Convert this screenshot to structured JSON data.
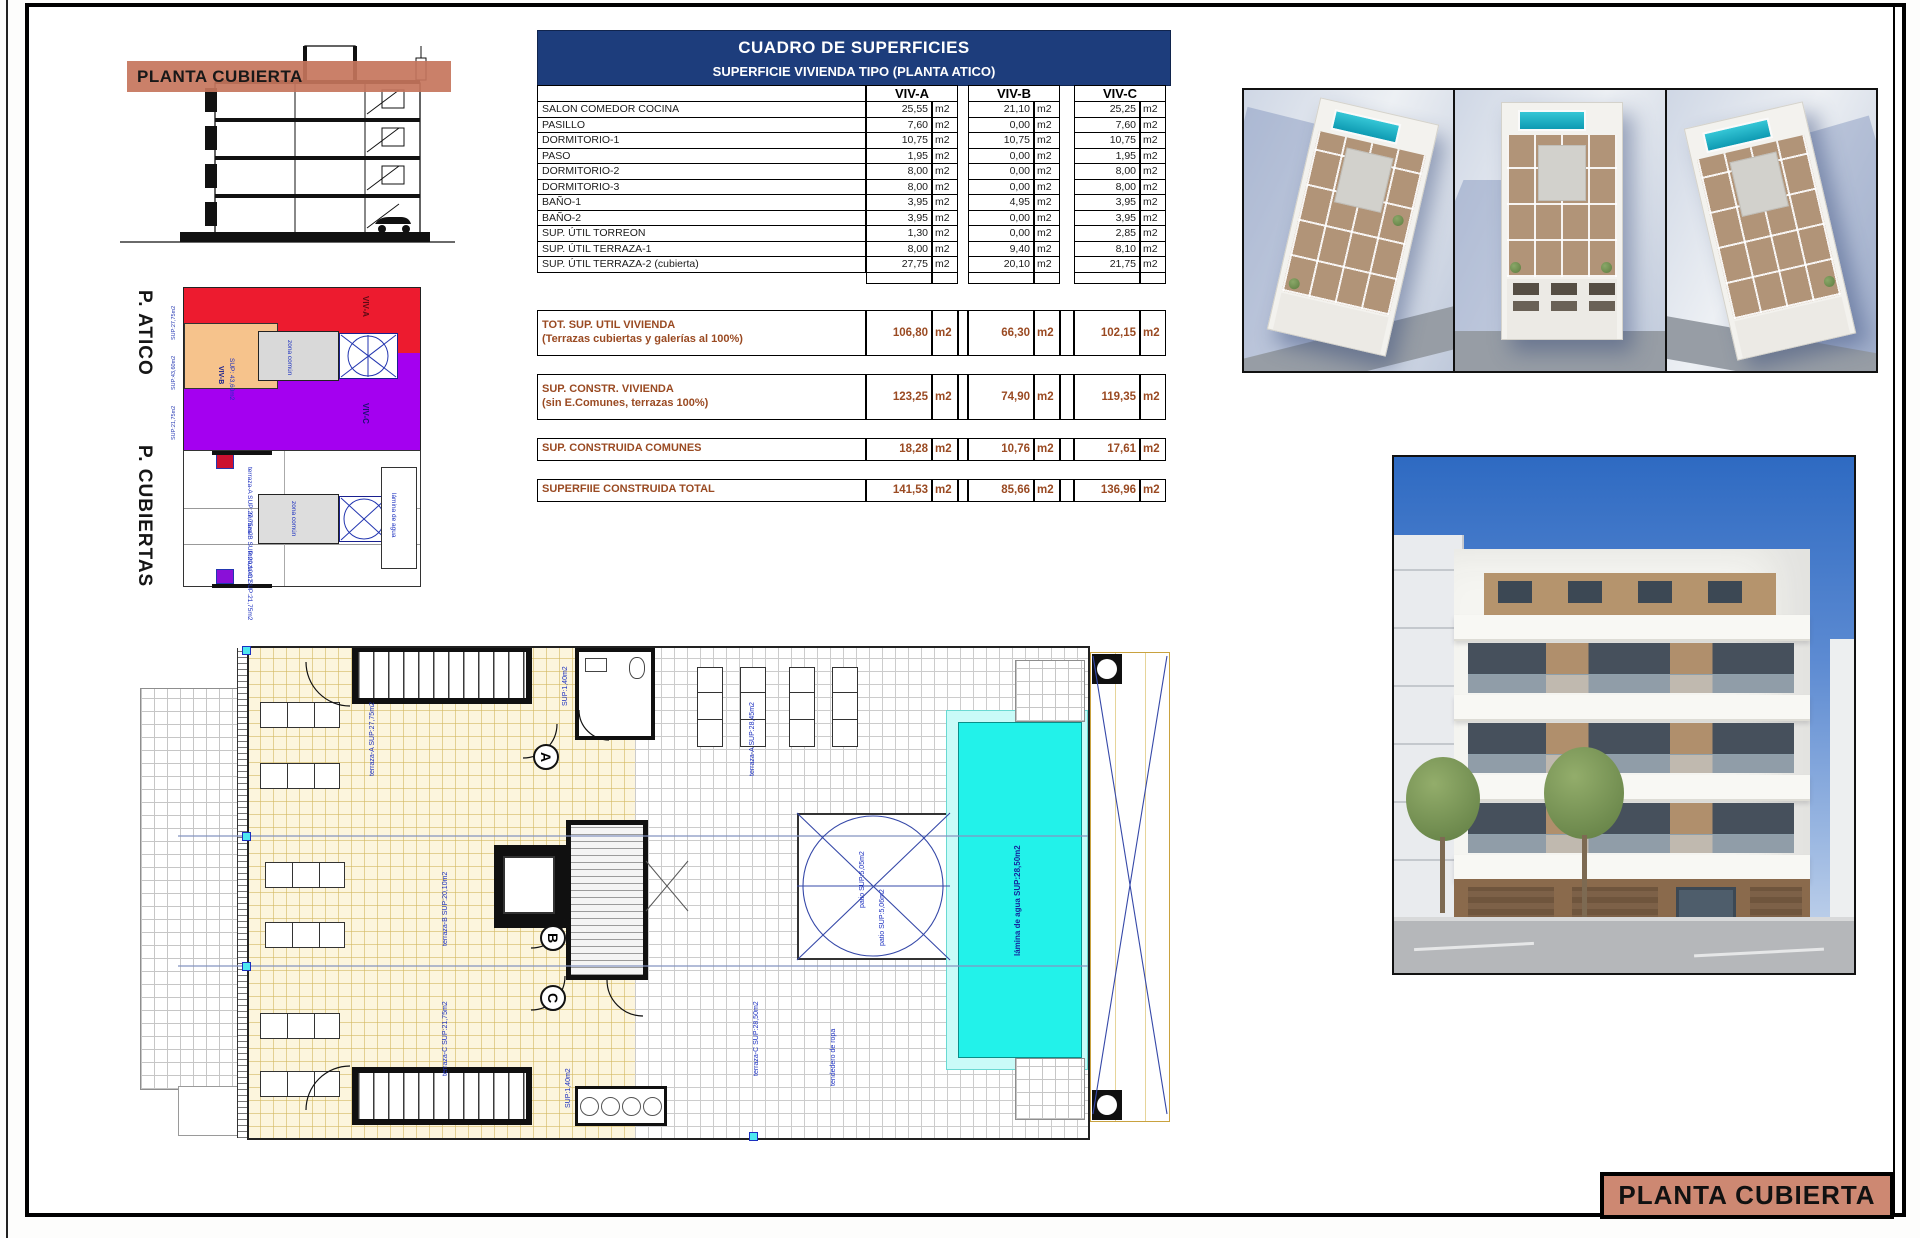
{
  "section": {
    "band_label": "PLANTA CUBIERTA"
  },
  "atico": {
    "title": "P. ATICO",
    "viv_a": "VIV-A",
    "viv_b": "VIV-B",
    "viv_b_sup": "SUP: 43,60m2",
    "viv_c": "VIV-C",
    "zona": "zona común",
    "side_labels": [
      "SUP:27,75m2",
      "SUP:43,60m2",
      "SUP:21,75m2"
    ]
  },
  "cubiertas": {
    "title": "P. CUBIERTAS",
    "labels": {
      "t_a": "terraza-A SUP:27,75m2",
      "t_b": "terraza-B SUP:20,10m2",
      "t_c": "terraza-C SUP:21,75m2",
      "zona": "zona común",
      "pool": "lámina de agua"
    }
  },
  "table": {
    "title": "CUADRO DE SUPERFICIES",
    "subtitle": "SUPERFICIE VIVIENDA TIPO  (PLANTA ATICO)",
    "columns": [
      "VIV-A",
      "VIV-B",
      "VIV-C"
    ],
    "unit": "m2",
    "rows": [
      {
        "label": "SALON COMEDOR COCINA",
        "values": [
          "25,55",
          "21,10",
          "25,25"
        ]
      },
      {
        "label": "PASILLO",
        "values": [
          "7,60",
          "0,00",
          "7,60"
        ]
      },
      {
        "label": "DORMITORIO-1",
        "values": [
          "10,75",
          "10,75",
          "10,75"
        ]
      },
      {
        "label": "PASO",
        "values": [
          "1,95",
          "0,00",
          "1,95"
        ]
      },
      {
        "label": "DORMITORIO-2",
        "values": [
          "8,00",
          "0,00",
          "8,00"
        ]
      },
      {
        "label": "DORMITORIO-3",
        "values": [
          "8,00",
          "0,00",
          "8,00"
        ]
      },
      {
        "label": "BAÑO-1",
        "values": [
          "3,95",
          "4,95",
          "3,95"
        ]
      },
      {
        "label": "BAÑO-2",
        "values": [
          "3,95",
          "0,00",
          "3,95"
        ]
      },
      {
        "label": "SUP. ÚTIL TORREON",
        "values": [
          "1,30",
          "0,00",
          "2,85"
        ]
      },
      {
        "label": "SUP. ÚTIL TERRAZA-1",
        "values": [
          "8,00",
          "9,40",
          "8,10"
        ]
      },
      {
        "label": "SUP. ÚTIL TERRAZA-2 (cubierta)",
        "values": [
          "27,75",
          "20,10",
          "21,75"
        ]
      }
    ],
    "totals": [
      {
        "label": "TOT. SUP. UTIL VIVIENDA",
        "sublabel": "(Terrazas cubiertas y galerías al 100%)",
        "values": [
          "106,80",
          "66,30",
          "102,15"
        ]
      },
      {
        "label": "SUP. CONSTR. VIVIENDA",
        "sublabel": "(sin E.Comunes, terrazas 100%)",
        "values": [
          "123,25",
          "74,90",
          "119,35"
        ]
      },
      {
        "label": "SUP. CONSTRUIDA COMUNES",
        "sublabel": "",
        "values": [
          "18,28",
          "10,76",
          "17,61"
        ]
      },
      {
        "label": "SUPERFIIE CONSTRUIDA TOTAL",
        "sublabel": "",
        "values": [
          "141,53",
          "85,66",
          "136,96"
        ]
      }
    ]
  },
  "plan": {
    "doors": {
      "a": "A",
      "b": "B",
      "c": "C"
    },
    "labels": {
      "terraza_a": "terraza-A SUP:27,75m2",
      "terraza_b": "terraza-B SUP:20,10m2",
      "terraza_c": "terraza-C SUP:21,75m2",
      "deck_a": "terraza-A SUP:28,45m2",
      "deck_c": "terraza-C SUP:28,50m2",
      "tendedero": "tendedero de ropa",
      "patio1": "patio SUP:5,05m2",
      "patio2": "patio SUP:5,06m2",
      "pool": "lámina de agua SUP:28,50m2",
      "bath_a": "SUP:1,40m2",
      "bath_c": "SUP:1,40m2"
    }
  },
  "title_block": {
    "label": "PLANTA CUBIERTA"
  },
  "colors": {
    "salmon_band": "#c6755c",
    "title_box": "#cd8872",
    "table_header_navy": "#1d3d7c",
    "totals_brown": "#9a4a22",
    "atico_red": "#ed1b2f",
    "atico_purple": "#a400f0",
    "atico_orange": "#f6c38c",
    "pool_cyan": "#22f2ea",
    "cad_blue": "#2336b0"
  }
}
